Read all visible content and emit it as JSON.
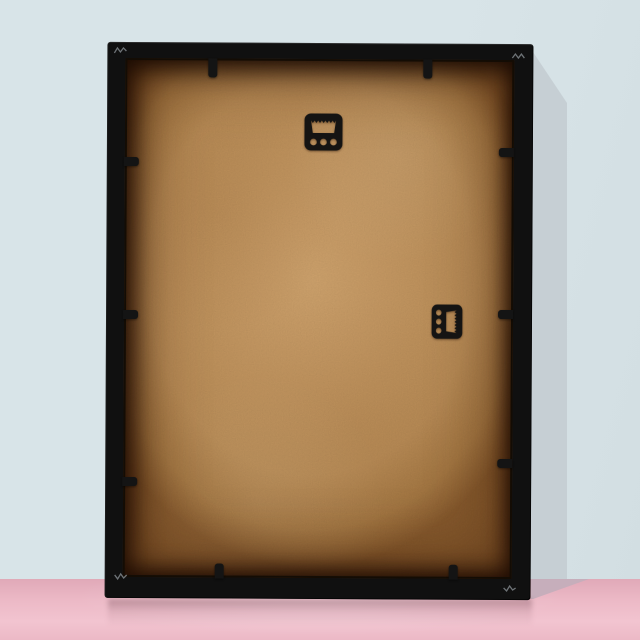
{
  "scene": {
    "subject": "back of a black picture frame standing on a pink floor against a light blue wall",
    "view": "rear view, slight right-side cast shadow"
  },
  "colors": {
    "wall": "#d8e4e8",
    "wall_edge": "#d2dee2",
    "wall_shadow": "#b4bec5",
    "wall_shadow_light": "#c6cfd4",
    "floor": "#ecb9c6",
    "floor_deep": "#e0a9b8",
    "floor_sheen": "#f2c4d0",
    "floor_shadow": "#c6aebb",
    "frame_black": "#101010",
    "backing_center": "#d2a56e",
    "backing_mid": "#c4965f",
    "backing_edge": "#8a5c2e",
    "hardware_black": "#151413",
    "clip_black": "#141414",
    "corner_mark": "#8e959a"
  },
  "objects": {
    "frame": {
      "name": "picture-frame-back",
      "finish": "black",
      "orientation": "portrait"
    },
    "backing": {
      "name": "mdf-backing-board",
      "appearance": "mottled tan hardboard with dark edge shadow"
    },
    "hangers": [
      {
        "name": "sawtooth-hanger-top",
        "position": "top-center",
        "holes": 3
      },
      {
        "name": "sawtooth-hanger-right",
        "position": "right-middle",
        "holes": 3,
        "rotation_deg": 90
      }
    ],
    "clips": {
      "top": 2,
      "bottom": 2,
      "left": 3,
      "right": 3,
      "total": 10
    }
  }
}
